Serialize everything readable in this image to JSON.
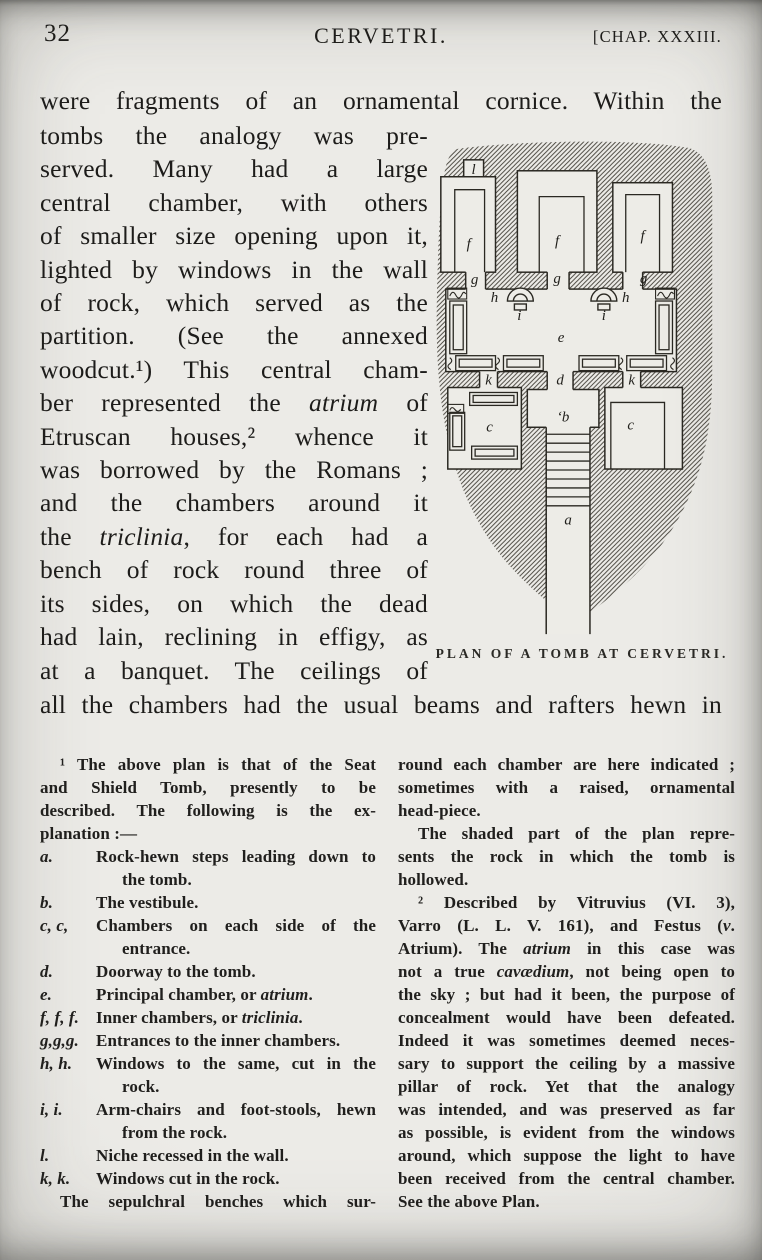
{
  "colors": {
    "paper": "#ecebe7",
    "ink": "#1d1c1a",
    "figure_ink": "#2a2822"
  },
  "page": {
    "number": "32",
    "running_title": "CERVETRI.",
    "chapter": "[CHAP. XXXIII."
  },
  "main_text": {
    "opening_line": "were fragments of an ornamental cornice.  Within the",
    "column_lines": [
      "tombs the analogy was pre-",
      "served.  Many had a large",
      "central chamber, with others",
      "of smaller size opening upon it,",
      "lighted by windows in the wall",
      "of rock, which served as the",
      "partition.  (See the annexed",
      "woodcut.¹)  This central cham-",
      "ber represented the *atrium* of",
      "Etruscan houses,² whence it",
      "was borrowed by the Romans ;",
      "and the chambers around it",
      "the *triclinia*, for each had a",
      "bench of rock round three of",
      "its sides, on which the dead",
      "had lain, reclining in effigy, as",
      "at a banquet.  The ceilings of"
    ],
    "closing_line": "all the chambers had the usual beams and rafters hewn in"
  },
  "figure": {
    "caption": "PLAN OF A TOMB AT CERVETRI.",
    "labels": [
      {
        "t": "l",
        "x": 46,
        "y": 41
      },
      {
        "t": "f",
        "x": 41,
        "y": 116
      },
      {
        "t": "f",
        "x": 130,
        "y": 113
      },
      {
        "t": "f",
        "x": 216,
        "y": 108
      },
      {
        "t": "g",
        "x": 47,
        "y": 152
      },
      {
        "t": "g",
        "x": 130,
        "y": 151
      },
      {
        "t": "g",
        "x": 217,
        "y": 151
      },
      {
        "t": "h",
        "x": 67,
        "y": 170
      },
      {
        "t": "h",
        "x": 199,
        "y": 170
      },
      {
        "t": "i",
        "x": 92,
        "y": 188
      },
      {
        "t": "i",
        "x": 177,
        "y": 188
      },
      {
        "t": "e",
        "x": 134,
        "y": 210
      },
      {
        "t": "k",
        "x": 61,
        "y": 253
      },
      {
        "t": "d",
        "x": 133,
        "y": 253
      },
      {
        "t": "k",
        "x": 205,
        "y": 253
      },
      {
        "t": "‘b",
        "x": 136,
        "y": 290
      },
      {
        "t": "c",
        "x": 62,
        "y": 300
      },
      {
        "t": "c",
        "x": 204,
        "y": 298
      },
      {
        "t": "a",
        "x": 141,
        "y": 394
      }
    ]
  },
  "footnotes": {
    "left": {
      "intro_lines": [
        {
          "text": "¹ The above plan is that of the Seat",
          "indent": true
        },
        "and Shield Tomb, presently to be",
        "described.  The following is the ex-",
        {
          "text": "planation :—",
          "justify": false
        }
      ],
      "items": [
        {
          "label": "a.",
          "lines": [
            {
              "text": "Rock-hewn steps leading down to",
              "justify": true
            },
            "the tomb."
          ]
        },
        {
          "label": "b.",
          "lines": [
            "The vestibule."
          ]
        },
        {
          "label": "c, c,",
          "lines": [
            {
              "text": "Chambers on each side of the",
              "justify": true
            },
            "entrance."
          ]
        },
        {
          "label": "d.",
          "lines": [
            "Doorway to the tomb."
          ]
        },
        {
          "label": "e.",
          "lines": [
            "Principal chamber, or *atrium*."
          ]
        },
        {
          "label": "f, f, f.",
          "lines": [
            "Inner chambers, or *triclinia*."
          ]
        },
        {
          "label": "g,g,g.",
          "lines": [
            "Entrances to the inner chambers."
          ]
        },
        {
          "label": "h, h.",
          "lines": [
            {
              "text": "Windows to the same, cut in the",
              "justify": true
            },
            "rock."
          ]
        },
        {
          "label": "i, i.",
          "lines": [
            {
              "text": "Arm-chairs and foot-stools, hewn",
              "justify": true
            },
            "from the rock."
          ]
        },
        {
          "label": "l.",
          "lines": [
            "Niche recessed in the wall."
          ]
        },
        {
          "label": "k, k.",
          "lines": [
            "Windows cut in the rock."
          ]
        }
      ],
      "closing_line": {
        "text": "The sepulchral benches which sur-",
        "indent": true
      }
    },
    "right": {
      "lines": [
        "round each chamber are here indicated ;",
        "sometimes with a raised, ornamental",
        {
          "text": "head-piece.",
          "justify": false
        },
        {
          "text": "The shaded part of the plan repre-",
          "indent": true
        },
        "sents the rock in which the tomb is",
        {
          "text": "hollowed.",
          "justify": false
        },
        {
          "text": "² Described by Vitruvius (VI. 3),",
          "indent": true
        },
        "Varro (L. L. V. 161), and Festus (*v*.",
        "Atrium).  The *atrium* in this case was",
        "not a true *cavædium*, not being open to",
        "the sky ; but had it been, the purpose of",
        "concealment would have been defeated.",
        "Indeed it was sometimes deemed neces-",
        "sary to support the ceiling by a massive",
        "pillar of rock.  Yet that the analogy",
        "was intended, and was preserved as far",
        "as possible, is evident from the windows",
        "around, which suppose the light to have",
        "been received from the central chamber.",
        {
          "text": "See the above Plan.",
          "justify": false
        }
      ]
    }
  }
}
